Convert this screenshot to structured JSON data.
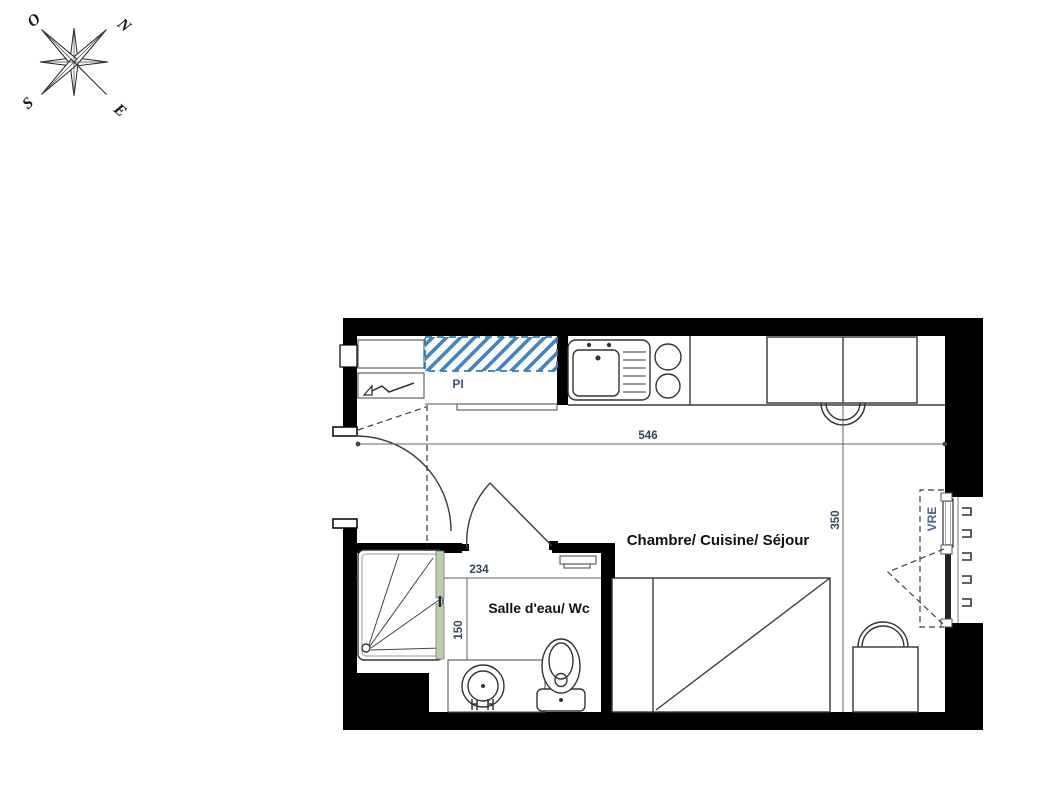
{
  "compass": {
    "letters": [
      "O",
      "N",
      "S",
      "E"
    ]
  },
  "rooms": {
    "main": "Chambre/ Cuisine/ Séjour",
    "bath": "Salle d'eau/ Wc"
  },
  "annotations": {
    "closet": "PI",
    "window_shutter": "VRE"
  },
  "dimensions": {
    "main_width": "546",
    "main_depth": "350",
    "bath_width": "234",
    "bath_depth": "150"
  },
  "colors": {
    "wall": "#000000",
    "line": "#3c3c3c",
    "hatch_blue": "#3d85c8",
    "glass_green": "#b9cfae",
    "dim_text": "#37475a",
    "closet_text": "#3d5573",
    "shutter_text": "#44608c",
    "label_text": "#111111"
  }
}
